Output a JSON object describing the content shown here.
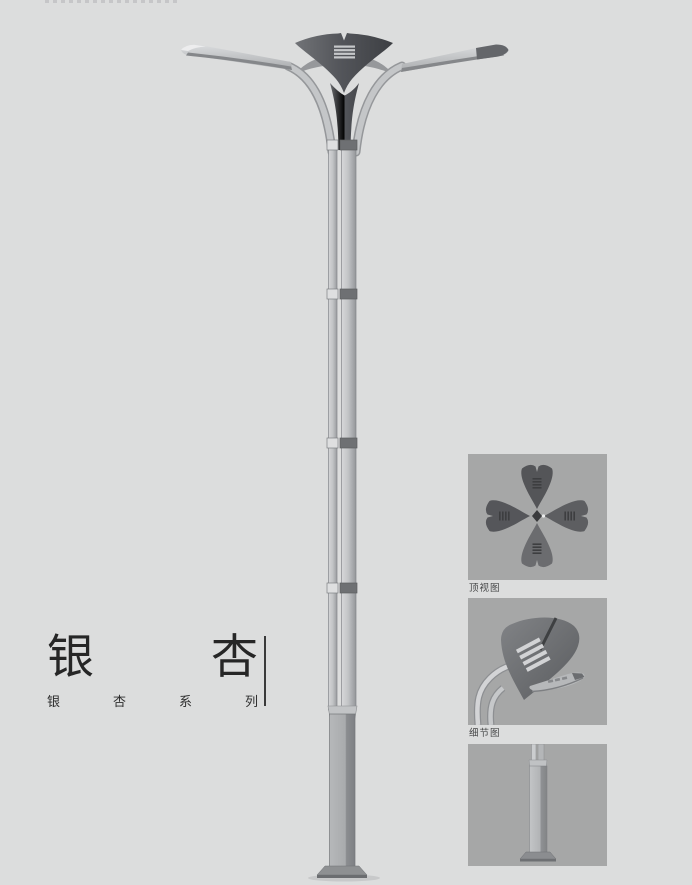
{
  "page": {
    "background_color": "#dcdddd"
  },
  "title": {
    "first_char": "银",
    "second_char": "杏",
    "series_chars": [
      "银",
      "杏",
      "系",
      "列"
    ],
    "series_text": "银杏系列"
  },
  "panels": [
    {
      "id": "top-view",
      "label": "顶视图"
    },
    {
      "id": "detail-view",
      "label": "细节图"
    },
    {
      "id": "base-view",
      "label": ""
    }
  ],
  "illustration": {
    "subject_icon": "ginkgo-street-lamp-icon",
    "colors": {
      "canopy_dark": "#4c4e52",
      "pole_light": "#c6c8ca",
      "metal_mid": "#8f9193",
      "panel_background": "#a6a7a7",
      "text": "#262626"
    }
  }
}
